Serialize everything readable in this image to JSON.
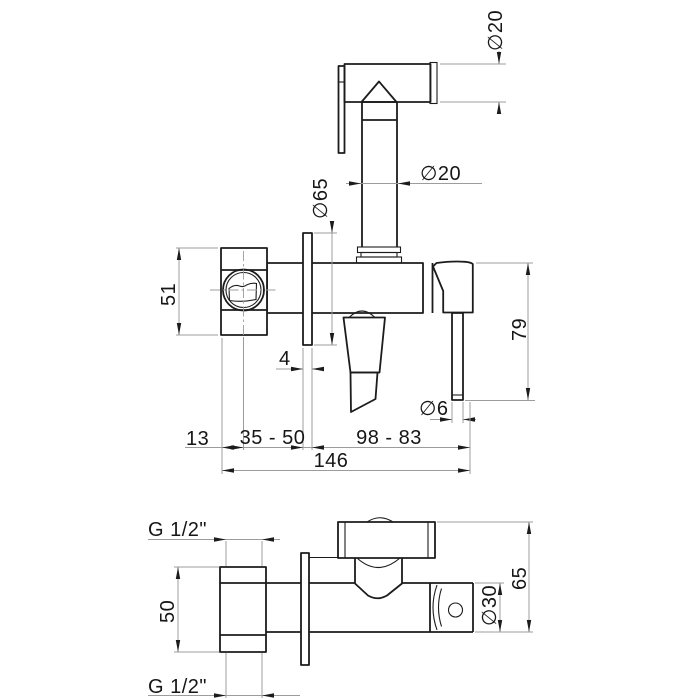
{
  "drawing": {
    "type": "technical-dimension-drawing",
    "colors": {
      "object_line": "#1c1c1c",
      "dimension_line": "#9c9c9c",
      "text": "#161616",
      "background": "#ffffff"
    }
  },
  "labels": {
    "dia20_head": "∅20",
    "dia20_tube": "∅20",
    "dia65_flange": "∅65",
    "len51": "51",
    "thick4": "4",
    "len79": "79",
    "dia6_rod": "∅6",
    "len13": "13",
    "range35_50": "35 - 50",
    "range98_83": "98 - 83",
    "len146": "146",
    "g_half_top": "G 1/2\"",
    "len50": "50",
    "g_half_bottom": "G 1/2\"",
    "dia30_body": "∅30",
    "len65": "65"
  }
}
